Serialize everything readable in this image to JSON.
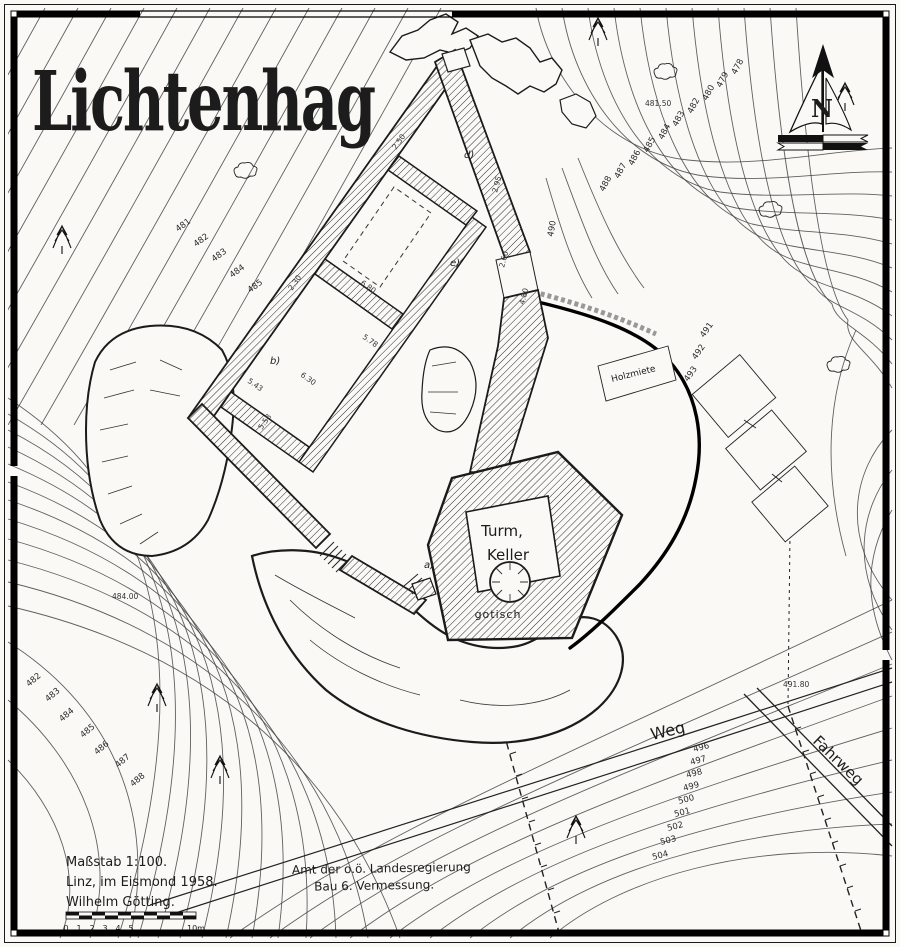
{
  "title": "Lichtenhag",
  "compass": {
    "north": "N"
  },
  "castle": {
    "tower": {
      "line1": "Turm,",
      "line2": "Keller",
      "note": "gotisch"
    },
    "markers": {
      "a": "a)",
      "b": "b)",
      "d": "d)",
      "e": "e)"
    },
    "measurements": [
      "2.50",
      "2.30",
      "2.95",
      "6.80",
      "6.30",
      "5.43",
      "5.58",
      "5.78",
      "2.60",
      "4.80"
    ]
  },
  "features": {
    "weg": "Weg",
    "fahrweg": "Fahrweg",
    "shed": "Holzmiete"
  },
  "contours": {
    "upper_left": [
      "481",
      "482",
      "483",
      "484",
      "485"
    ],
    "lower_left": [
      "482",
      "483",
      "484",
      "485",
      "486",
      "487",
      "488"
    ],
    "top_right": [
      "478",
      "479",
      "480",
      "482",
      "483",
      "484",
      "485",
      "486",
      "487",
      "488"
    ],
    "right_mid": [
      "491",
      "492",
      "493"
    ],
    "east": "490",
    "lower_right": [
      "496",
      "497",
      "498",
      "499",
      "500",
      "501",
      "502",
      "503",
      "504"
    ]
  },
  "spot_heights": [
    "481.50",
    "484.00",
    "491.80"
  ],
  "legend": {
    "scale": "Maßstab 1:100.",
    "place_date": "Linz, im Eismond 1958.",
    "author": "Wilhelm Götting.",
    "scalebar_ticks": [
      "0",
      "1",
      "2",
      "3",
      "4",
      "5"
    ],
    "scalebar_end": "10m"
  },
  "agency": {
    "line1": "Amt der o.ö. Landesregierung",
    "line2": "Bau 6. Vermessung."
  },
  "colors": {
    "paper": "#faf9f6",
    "ink": "#1a1a1a"
  }
}
